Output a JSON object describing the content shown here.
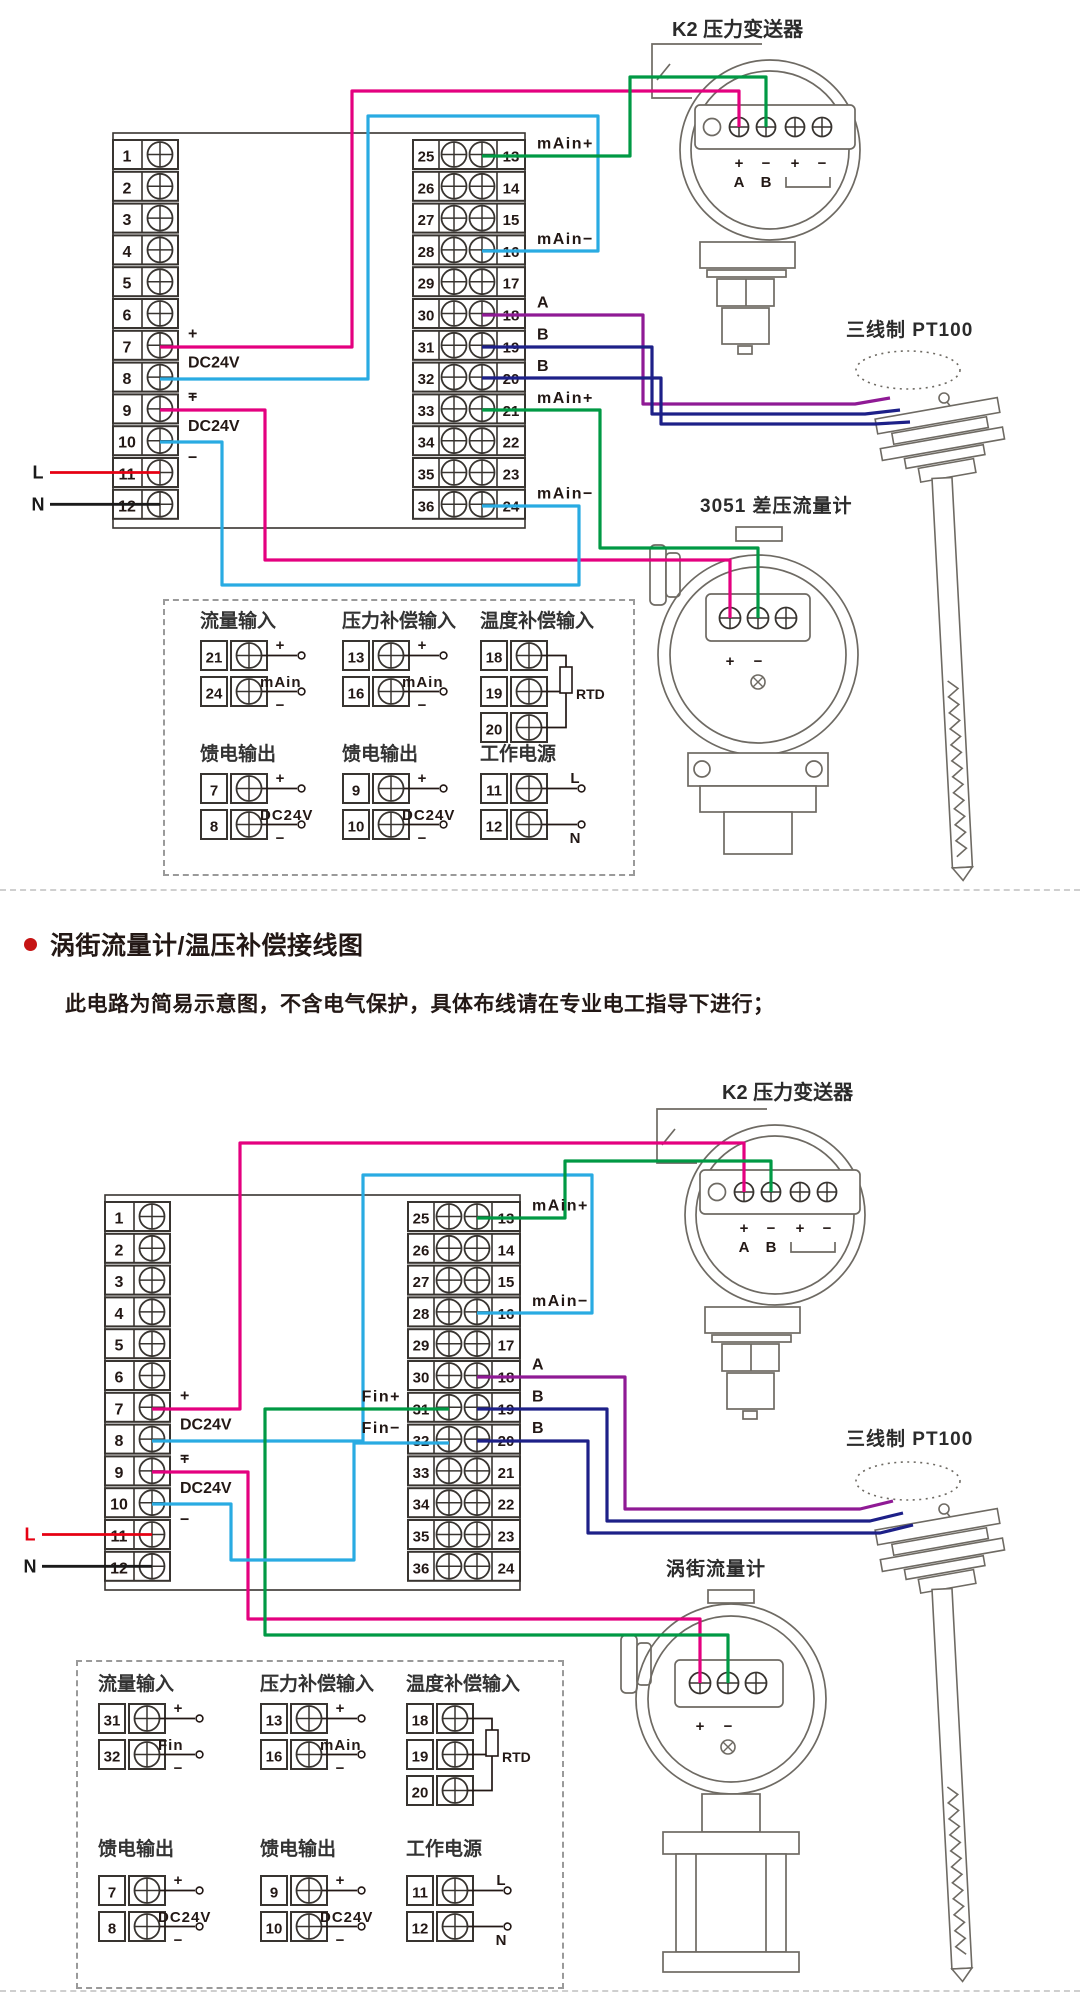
{
  "page": {
    "section_title": "涡街流量计/温压补偿接线图",
    "section_note": "此电路为简易示意图，不含电气保护，具体布线请在专业电工指导下进行；",
    "bullet_color": "#c61414",
    "divider_color": "#cfcfcf"
  },
  "colors": {
    "wire_magenta": "#e4007f",
    "wire_cyan": "#29abe2",
    "wire_green": "#009944",
    "wire_purple": "#8f1a95",
    "wire_navy": "#1d2088",
    "wire_red": "#e60012",
    "wire_black": "#1a1a1a",
    "line_art": "#6e6a63",
    "strip_stroke": "#383430",
    "text": "#231815",
    "device_label": "#2b2b2b"
  },
  "diagrams": [
    {
      "name": "差压流量计温压补偿接线图",
      "transmitter": {
        "label": "K2 压力变送器",
        "terminal_marks": [
          "+",
          "−",
          "+",
          "−"
        ],
        "terminal_letters": [
          "A",
          "B"
        ]
      },
      "pt100": {
        "label": "三线制 PT100"
      },
      "flowmeter": {
        "label": "3051 差压流量计",
        "terminal_marks": [
          "+",
          "−"
        ]
      },
      "left_strip": {
        "numbers": [
          "1",
          "2",
          "3",
          "4",
          "5",
          "6",
          "7",
          "8",
          "9",
          "10",
          "11",
          "12"
        ],
        "annotations": [
          {
            "terminal": 7,
            "text": "+",
            "pos": "plus"
          },
          {
            "terminal": 8,
            "text": "DC24V",
            "pos": "top"
          },
          {
            "terminal": 8,
            "text": "−",
            "pos": "minus"
          },
          {
            "terminal": 9,
            "text": "+",
            "pos": "plus"
          },
          {
            "terminal": 10,
            "text": "DC24V",
            "pos": "top"
          },
          {
            "terminal": 10,
            "text": "−",
            "pos": "minus"
          }
        ],
        "power": [
          {
            "terminal": 11,
            "text": "L",
            "wire_color": "#e60012",
            "text_color": "#1a1a1a"
          },
          {
            "terminal": 12,
            "text": "N",
            "wire_color": "#1a1a1a",
            "text_color": "#1a1a1a"
          }
        ]
      },
      "right_strip": {
        "left_numbers": [
          "25",
          "26",
          "27",
          "28",
          "29",
          "30",
          "31",
          "32",
          "33",
          "34",
          "35",
          "36"
        ],
        "right_numbers": [
          "13",
          "14",
          "15",
          "16",
          "17",
          "18",
          "19",
          "20",
          "21",
          "22",
          "23",
          "24"
        ],
        "annotations_right": [
          {
            "terminal": 1,
            "text": "mAin+"
          },
          {
            "terminal": 4,
            "text": "mAin−"
          },
          {
            "terminal": 6,
            "text": "A"
          },
          {
            "terminal": 7,
            "text": "B"
          },
          {
            "terminal": 8,
            "text": "B"
          },
          {
            "terminal": 9,
            "text": "mAin+"
          },
          {
            "terminal": 12,
            "text": "mAin−"
          }
        ],
        "annotations_left": []
      },
      "legend": {
        "sections": [
          {
            "title": "流量输入",
            "mid": "mAin",
            "rows": [
              {
                "n": "21",
                "tag": "+"
              },
              {
                "n": "24",
                "tag": "−"
              }
            ]
          },
          {
            "title": "压力补偿输入",
            "mid": "mAin",
            "rows": [
              {
                "n": "13",
                "tag": "+"
              },
              {
                "n": "16",
                "tag": "−"
              }
            ]
          },
          {
            "title": "温度补偿输入",
            "rtd": "RTD",
            "rows": [
              {
                "n": "18"
              },
              {
                "n": "19"
              },
              {
                "n": "20"
              }
            ]
          },
          {
            "title": "馈电输出",
            "mid": "DC24V",
            "rows": [
              {
                "n": "7",
                "tag": "+"
              },
              {
                "n": "8",
                "tag": "−"
              }
            ]
          },
          {
            "title": "馈电输出",
            "mid": "DC24V",
            "rows": [
              {
                "n": "9",
                "tag": "+"
              },
              {
                "n": "10",
                "tag": "−"
              }
            ]
          },
          {
            "title": "工作电源",
            "rows": [
              {
                "n": "11",
                "tag": "L"
              },
              {
                "n": "12",
                "tag": "N"
              }
            ]
          }
        ]
      }
    },
    {
      "name": "涡街流量计温压补偿接线图",
      "transmitter": {
        "label": "K2 压力变送器",
        "terminal_marks": [
          "+",
          "−",
          "+",
          "−"
        ],
        "terminal_letters": [
          "A",
          "B"
        ]
      },
      "pt100": {
        "label": "三线制 PT100"
      },
      "flowmeter": {
        "label": "涡街流量计",
        "terminal_marks": [
          "+",
          "−"
        ]
      },
      "left_strip": {
        "numbers": [
          "1",
          "2",
          "3",
          "4",
          "5",
          "6",
          "7",
          "8",
          "9",
          "10",
          "11",
          "12"
        ],
        "annotations": [
          {
            "terminal": 7,
            "text": "+",
            "pos": "plus"
          },
          {
            "terminal": 8,
            "text": "DC24V",
            "pos": "top"
          },
          {
            "terminal": 8,
            "text": "−",
            "pos": "minus"
          },
          {
            "terminal": 9,
            "text": "+",
            "pos": "plus"
          },
          {
            "terminal": 10,
            "text": "DC24V",
            "pos": "top"
          },
          {
            "terminal": 10,
            "text": "−",
            "pos": "minus"
          }
        ],
        "power": [
          {
            "terminal": 11,
            "text": "L",
            "wire_color": "#e60012",
            "text_color": "#e60012"
          },
          {
            "terminal": 12,
            "text": "N",
            "wire_color": "#1a1a1a",
            "text_color": "#1a1a1a"
          }
        ]
      },
      "right_strip": {
        "left_numbers": [
          "25",
          "26",
          "27",
          "28",
          "29",
          "30",
          "31",
          "32",
          "33",
          "34",
          "35",
          "36"
        ],
        "right_numbers": [
          "13",
          "14",
          "15",
          "16",
          "17",
          "18",
          "19",
          "20",
          "21",
          "22",
          "23",
          "24"
        ],
        "annotations_right": [
          {
            "terminal": 1,
            "text": "mAin+"
          },
          {
            "terminal": 4,
            "text": "mAin−"
          },
          {
            "terminal": 6,
            "text": "A"
          },
          {
            "terminal": 7,
            "text": "B"
          },
          {
            "terminal": 8,
            "text": "B"
          }
        ],
        "annotations_left": [
          {
            "terminal": 7,
            "text": "Fin+"
          },
          {
            "terminal": 8,
            "text": "Fin−"
          }
        ]
      },
      "legend": {
        "sections": [
          {
            "title": "流量输入",
            "mid": "Fin",
            "rows": [
              {
                "n": "31",
                "tag": "+"
              },
              {
                "n": "32",
                "tag": "−"
              }
            ]
          },
          {
            "title": "压力补偿输入",
            "mid": "mAin",
            "rows": [
              {
                "n": "13",
                "tag": "+"
              },
              {
                "n": "16",
                "tag": "−"
              }
            ]
          },
          {
            "title": "温度补偿输入",
            "rtd": "RTD",
            "rows": [
              {
                "n": "18"
              },
              {
                "n": "19"
              },
              {
                "n": "20"
              }
            ]
          },
          {
            "title": "馈电输出",
            "mid": "DC24V",
            "rows": [
              {
                "n": "7",
                "tag": "+"
              },
              {
                "n": "8",
                "tag": "−"
              }
            ]
          },
          {
            "title": "馈电输出",
            "mid": "DC24V",
            "rows": [
              {
                "n": "9",
                "tag": "+"
              },
              {
                "n": "10",
                "tag": "−"
              }
            ]
          },
          {
            "title": "工作电源",
            "rows": [
              {
                "n": "11",
                "tag": "L"
              },
              {
                "n": "12",
                "tag": "N"
              }
            ]
          }
        ]
      }
    }
  ]
}
